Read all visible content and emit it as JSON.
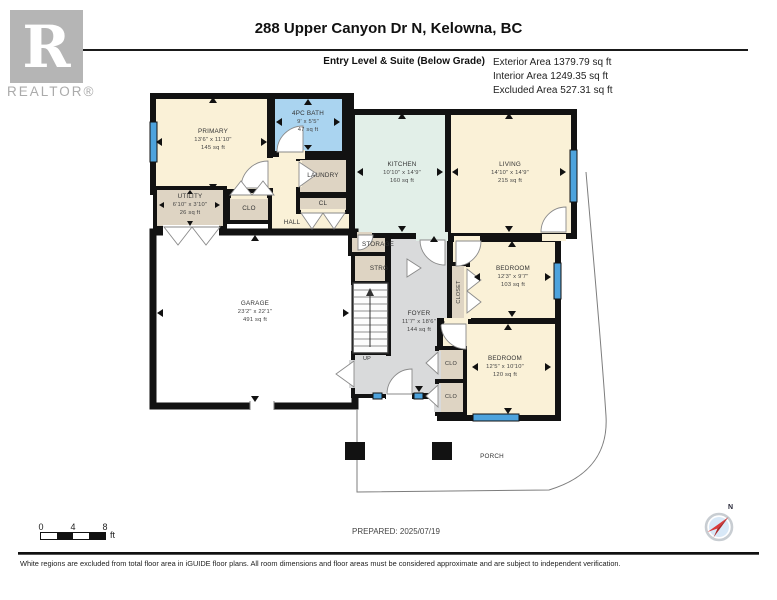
{
  "header": {
    "logo_letter": "R",
    "brand": "REALTOR®",
    "title": "288 Upper Canyon Dr N, Kelowna, BC",
    "level_label": "Entry Level & Suite (Below Grade)",
    "areas": [
      "Exterior Area 1379.79 sq ft",
      "Interior Area 1249.35 sq ft",
      "Excluded Area 527.31 sq ft"
    ]
  },
  "rooms": {
    "primary": {
      "name": "PRIMARY",
      "dims": "13'6\" x 11'10\"",
      "area": "145 sq ft"
    },
    "bath": {
      "name": "4PC BATH",
      "dims": "9' x 5'5\"",
      "area": "47 sq ft"
    },
    "utility": {
      "name": "UTILITY",
      "dims": "6'10\" x 3'10\"",
      "area": "26 sq ft"
    },
    "kitchen": {
      "name": "KITCHEN",
      "dims": "10'10\" x 14'9\"",
      "area": "160 sq ft"
    },
    "living": {
      "name": "LIVING",
      "dims": "14'10\" x 14'9\"",
      "area": "215 sq ft"
    },
    "garage": {
      "name": "GARAGE",
      "dims": "23'2\" x 22'1\"",
      "area": "491 sq ft"
    },
    "foyer": {
      "name": "FOYER",
      "dims": "11'7\" x 18'6\"",
      "area": "144 sq ft"
    },
    "bedroom1": {
      "name": "BEDROOM",
      "dims": "12'3\" x 9'7\"",
      "area": "103 sq ft"
    },
    "bedroom2": {
      "name": "BEDROOM",
      "dims": "12'5\" x 10'10\"",
      "area": "120 sq ft"
    },
    "laundry": {
      "name": "LAUNDRY"
    },
    "hall": {
      "name": "HALL"
    },
    "cl": {
      "name": "CL"
    },
    "clo_primary": {
      "name": "CLO"
    },
    "storage": {
      "name": "STORAGE"
    },
    "strg": {
      "name": "STRG"
    },
    "closet": {
      "name": "CLOSET"
    },
    "clo_a": {
      "name": "CLO"
    },
    "clo_b": {
      "name": "CLO"
    },
    "porch": {
      "name": "PORCH"
    },
    "up": {
      "name": "UP"
    }
  },
  "scale_bar": {
    "ticks": [
      "0",
      "4",
      "8"
    ],
    "unit": "ft"
  },
  "prepared": "PREPARED: 2025/07/19",
  "compass": {
    "north_label": "N"
  },
  "footer": "White regions are excluded from total floor area in iGUIDE floor plans. All room dimensions and floor areas must be considered approximate and are subject to independent verification.",
  "palette": {
    "room_cream": "#faf1d7",
    "room_tan": "#ded4c3",
    "room_blue": "#aad4f0",
    "room_green": "#e2efe8",
    "room_grey": "#d9dadb",
    "wall": "#121212",
    "window_blue": "#4da3dd",
    "compass_red": "#d93a3a"
  }
}
